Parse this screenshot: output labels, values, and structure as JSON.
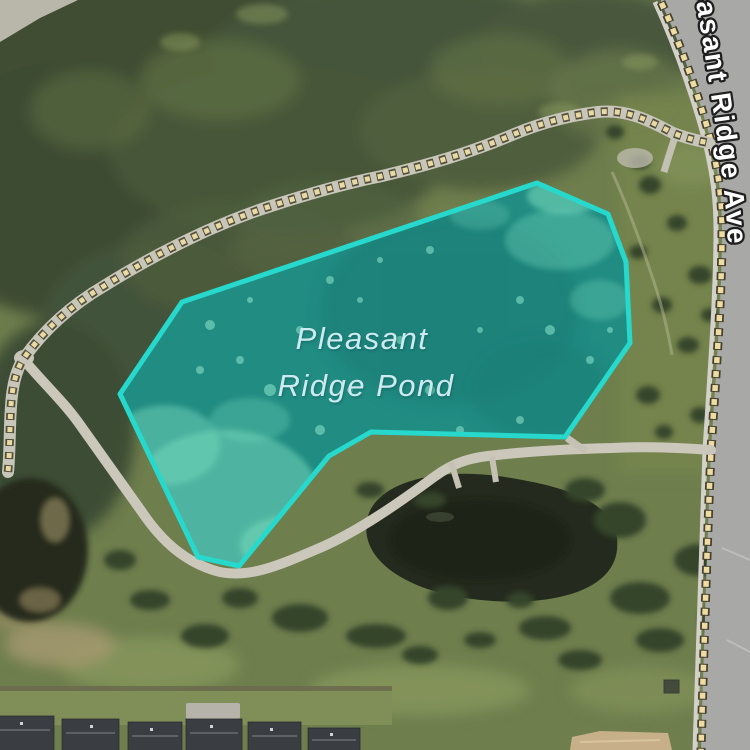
{
  "map": {
    "pond_label": {
      "full_name": "Pleasant Ridge Pond",
      "line1": "Pleasant",
      "line2": "Ridge Pond",
      "color": "#cdeaf0"
    },
    "road_label": {
      "name": "Pleasant Ridge Ave",
      "visible_fragment": "sant Ridge Ave",
      "color": "#ffffff",
      "outline_color": "#1f1f1f"
    },
    "highlight": {
      "feature": "Pleasant Ridge Pond",
      "points": "537,183 608,214 626,262 630,343 565,437 371,432 329,456 239,566 198,557 120,394 182,302",
      "stroke_color": "#26d9cc",
      "fill_color": "rgba(38,217,204,0.28)",
      "water_color": "#1f6f66"
    }
  }
}
